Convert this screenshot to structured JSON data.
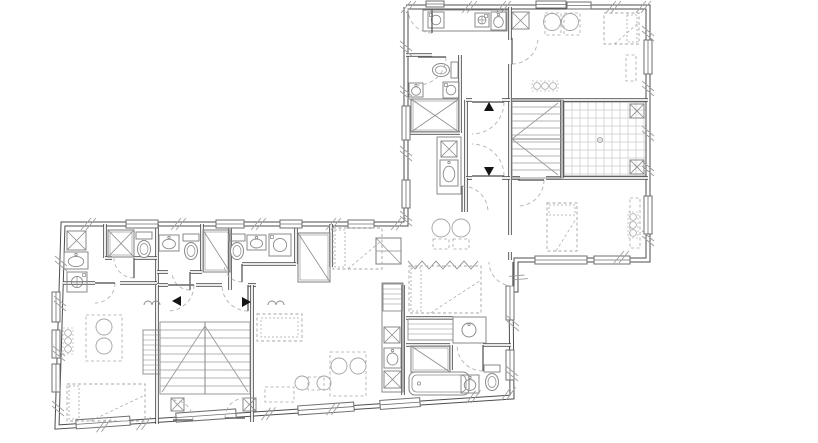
{
  "meta": {
    "canvas": {
      "w": 818,
      "h": 443
    },
    "palette": {
      "bg": "#ffffff",
      "wall": "#4d4d4d",
      "wallCore": "#ffffff",
      "fixture": "#8a8a8a",
      "furniture": "#a6a6a6",
      "window": "#6f6f6f",
      "door": "#b3b3b3",
      "leaf": "#666666",
      "stair": "#9a9a9a",
      "grid": "#cccccc",
      "marker": "#141414",
      "hatch": "#9e9e9e"
    }
  },
  "walls": {
    "exterior": [
      [
        406,
        7
      ],
      [
        648,
        7
      ],
      [
        648,
        260
      ],
      [
        516,
        260
      ],
      [
        516,
        290
      ],
      [
        511,
        290
      ],
      [
        512,
        397
      ],
      [
        57,
        427
      ],
      [
        63,
        224
      ],
      [
        406,
        224
      ],
      [
        406,
        7
      ]
    ],
    "interior": [
      [
        [
          510,
          7
        ],
        [
          510,
          40
        ]
      ],
      [
        [
          510,
          64
        ],
        [
          510,
          100
        ]
      ],
      [
        [
          510,
          100
        ],
        [
          510,
          235
        ]
      ],
      [
        [
          510,
          252
        ],
        [
          510,
          260
        ]
      ],
      [
        [
          512,
          100
        ],
        [
          648,
          100
        ]
      ],
      [
        [
          512,
          178
        ],
        [
          520,
          178
        ]
      ],
      [
        [
          546,
          178
        ],
        [
          648,
          178
        ]
      ],
      [
        [
          562,
          100
        ],
        [
          562,
          178
        ]
      ],
      [
        [
          460,
          55
        ],
        [
          460,
          133
        ]
      ],
      [
        [
          406,
          55
        ],
        [
          432,
          55
        ]
      ],
      [
        [
          406,
          133
        ],
        [
          460,
          133
        ]
      ],
      [
        [
          466,
          100
        ],
        [
          466,
          178
        ]
      ],
      [
        [
          466,
          100
        ],
        [
          472,
          100
        ]
      ],
      [
        [
          502,
          100
        ],
        [
          510,
          100
        ]
      ],
      [
        [
          466,
          178
        ],
        [
          472,
          178
        ]
      ],
      [
        [
          502,
          178
        ],
        [
          510,
          178
        ]
      ],
      [
        [
          466,
          178
        ],
        [
          466,
          212
        ]
      ],
      [
        [
          105,
          224
        ],
        [
          105,
          258
        ]
      ],
      [
        [
          157,
          224
        ],
        [
          157,
          283
        ]
      ],
      [
        [
          202,
          224
        ],
        [
          202,
          272
        ]
      ],
      [
        [
          230,
          224
        ],
        [
          230,
          290
        ]
      ],
      [
        [
          296,
          224
        ],
        [
          296,
          264
        ]
      ],
      [
        [
          331,
          224
        ],
        [
          331,
          267
        ]
      ],
      [
        [
          63,
          283
        ],
        [
          95,
          283
        ]
      ],
      [
        [
          120,
          283
        ],
        [
          157,
          283
        ]
      ],
      [
        [
          157,
          285
        ],
        [
          168,
          285
        ]
      ],
      [
        [
          196,
          285
        ],
        [
          222,
          285
        ]
      ],
      [
        [
          248,
          285
        ],
        [
          256,
          285
        ]
      ],
      [
        [
          242,
          264
        ],
        [
          296,
          264
        ]
      ],
      [
        [
          105,
          258
        ],
        [
          112,
          258
        ]
      ],
      [
        [
          134,
          258
        ],
        [
          157,
          258
        ]
      ],
      [
        [
          157,
          272
        ],
        [
          168,
          272
        ]
      ],
      [
        [
          190,
          272
        ],
        [
          202,
          272
        ]
      ],
      [
        [
          157,
          285
        ],
        [
          157,
          424
        ]
      ],
      [
        [
          252,
          285
        ],
        [
          252,
          422
        ]
      ],
      [
        [
          403,
          285
        ],
        [
          403,
          395
        ]
      ],
      [
        [
          406,
          345
        ],
        [
          450,
          345
        ]
      ],
      [
        [
          483,
          345
        ],
        [
          511,
          345
        ]
      ],
      [
        [
          451,
          345
        ],
        [
          451,
          370
        ]
      ],
      [
        [
          406,
          318
        ],
        [
          453,
          318
        ]
      ]
    ]
  },
  "windows": [
    [
      426,
      1,
      18,
      6,
      0
    ],
    [
      536,
      1,
      30,
      7,
      0
    ],
    [
      567,
      2,
      24,
      7,
      0
    ],
    [
      644,
      40,
      8,
      34,
      0
    ],
    [
      644,
      196,
      8,
      38,
      0
    ],
    [
      535,
      256,
      52,
      8,
      0
    ],
    [
      594,
      256,
      36,
      8,
      0
    ],
    [
      402,
      106,
      8,
      34,
      0
    ],
    [
      402,
      180,
      8,
      28,
      0
    ],
    [
      126,
      220,
      32,
      8,
      0
    ],
    [
      216,
      220,
      28,
      8,
      0
    ],
    [
      280,
      220,
      22,
      8,
      0
    ],
    [
      348,
      220,
      26,
      8,
      0
    ],
    [
      52,
      292,
      8,
      30,
      0
    ],
    [
      52,
      330,
      8,
      28,
      0
    ],
    [
      52,
      364,
      8,
      28,
      0
    ],
    [
      506,
      286,
      8,
      34,
      0
    ],
    [
      506,
      350,
      8,
      30,
      0
    ],
    [
      76,
      418,
      54,
      9,
      -4
    ],
    [
      176,
      411,
      60,
      9,
      -4
    ],
    [
      298,
      404,
      56,
      9,
      -4
    ],
    [
      380,
      399,
      40,
      9,
      -4
    ]
  ],
  "doors": [
    [
      432,
      9,
      24,
      90,
      180
    ],
    [
      418,
      57,
      28,
      0,
      90
    ],
    [
      472,
      102,
      32,
      0,
      90
    ],
    [
      472,
      176,
      32,
      0,
      -90
    ],
    [
      512,
      38,
      26,
      90,
      0
    ],
    [
      518,
      180,
      26,
      0,
      90
    ],
    [
      95,
      283,
      20,
      0,
      90
    ],
    [
      134,
      258,
      20,
      90,
      180
    ],
    [
      190,
      272,
      18,
      90,
      180
    ],
    [
      242,
      264,
      18,
      90,
      180
    ],
    [
      168,
      285,
      26,
      0,
      90
    ],
    [
      248,
      285,
      26,
      90,
      180
    ],
    [
      173,
      420,
      20,
      0,
      -90
    ],
    [
      245,
      418,
      20,
      180,
      270
    ],
    [
      483,
      345,
      26,
      90,
      180
    ],
    [
      513,
      262,
      24,
      90,
      180
    ],
    [
      462,
      212,
      26,
      -90,
      0
    ]
  ],
  "markers": [
    [
      489,
      107,
      "up"
    ],
    [
      489,
      171,
      "down"
    ],
    [
      177,
      301,
      "left"
    ],
    [
      246,
      302,
      "right"
    ]
  ],
  "stairs": [
    {
      "x": 512,
      "y": 100,
      "w": 50,
      "h": 78,
      "step": 7,
      "diag": [
        [
          512,
          139,
          558,
          103
        ],
        [
          512,
          139,
          558,
          175
        ]
      ],
      "mid": [
        512,
        139,
        562,
        139
      ]
    },
    {
      "x": 160,
      "y": 322,
      "w": 90,
      "h": 72,
      "step": 8,
      "diag": [
        [
          162,
          392,
          205,
          326
        ],
        [
          248,
          392,
          205,
          326
        ]
      ],
      "mid": [
        205,
        322,
        205,
        394
      ]
    }
  ],
  "grids": [
    [
      564,
      102,
      82,
      74,
      8
    ]
  ],
  "zigzags": [
    [
      408,
      265,
      480,
      4,
      7
    ]
  ],
  "bifolds": [
    [
      144,
      305,
      16
    ],
    [
      268,
      305,
      16
    ]
  ],
  "hatches": [
    [
      405,
      7,
      0
    ],
    [
      466,
      7,
      0
    ],
    [
      500,
      7,
      0
    ],
    [
      610,
      7,
      0
    ],
    [
      640,
      7,
      0
    ],
    [
      648,
      30,
      90
    ],
    [
      648,
      85,
      90
    ],
    [
      648,
      130,
      90
    ],
    [
      648,
      165,
      90
    ],
    [
      648,
      235,
      90
    ],
    [
      618,
      257,
      0
    ],
    [
      406,
      45,
      90
    ],
    [
      406,
      90,
      90
    ],
    [
      406,
      150,
      90
    ],
    [
      406,
      215,
      90
    ],
    [
      85,
      224,
      0
    ],
    [
      175,
      224,
      0
    ],
    [
      255,
      224,
      0
    ],
    [
      330,
      224,
      0
    ],
    [
      395,
      224,
      0
    ],
    [
      61,
      260,
      90
    ],
    [
      60,
      300,
      90
    ],
    [
      59,
      350,
      90
    ],
    [
      58,
      405,
      90
    ],
    [
      100,
      426,
      -4
    ],
    [
      140,
      424,
      -4
    ],
    [
      265,
      414,
      -4
    ],
    [
      330,
      409,
      -4
    ],
    [
      470,
      397,
      -4
    ],
    [
      505,
      394,
      -4
    ],
    [
      513,
      320,
      90
    ],
    [
      512,
      370,
      90
    ],
    [
      516,
      275,
      45
    ]
  ],
  "fixtures": [
    {
      "t": "counter",
      "x": 423,
      "y": 10,
      "w": 84,
      "h": 21
    },
    {
      "t": "counter",
      "x": 437,
      "y": 137,
      "w": 24,
      "h": 57
    },
    {
      "t": "counter",
      "x": 453,
      "y": 317,
      "w": 33,
      "h": 26
    },
    {
      "t": "counter",
      "x": 382,
      "y": 283,
      "w": 21,
      "h": 109
    },
    {
      "t": "shelf",
      "x": 383,
      "y": 284,
      "w": 19,
      "h": 27
    },
    {
      "t": "shelf",
      "x": 408,
      "y": 319,
      "w": 45,
      "h": 21
    },
    {
      "t": "shelf",
      "x": 143,
      "y": 330,
      "w": 17,
      "h": 44
    },
    {
      "t": "shelfs",
      "x": 376,
      "y": 238,
      "w": 25,
      "h": 26
    },
    {
      "t": "washer",
      "x": 428,
      "y": 12,
      "s": 16
    },
    {
      "t": "washer",
      "x": 443,
      "y": 82,
      "s": 16
    },
    {
      "t": "washer",
      "x": 269,
      "y": 234,
      "s": 22
    },
    {
      "t": "stove",
      "x": 475,
      "y": 13,
      "s": 14
    },
    {
      "t": "stove",
      "x": 67,
      "y": 272,
      "s": 20
    },
    {
      "t": "shaftx",
      "x": 512,
      "y": 12,
      "s": 17
    },
    {
      "t": "shaftx",
      "x": 67,
      "y": 231,
      "s": 19
    },
    {
      "t": "shaftx",
      "x": 384,
      "y": 371,
      "s": 17
    },
    {
      "t": "shaftx",
      "x": 384,
      "y": 327,
      "s": 16
    },
    {
      "t": "shaftx",
      "x": 441,
      "y": 141,
      "s": 16
    },
    {
      "t": "shaftx",
      "x": 171,
      "y": 398,
      "s": 13
    },
    {
      "t": "shaftx",
      "x": 243,
      "y": 398,
      "s": 13
    },
    {
      "t": "shaftx",
      "x": 630,
      "y": 104,
      "s": 14
    },
    {
      "t": "shaftx",
      "x": 630,
      "y": 160,
      "s": 14
    },
    {
      "t": "sink",
      "x": 491,
      "y": 12,
      "w": 15,
      "h": 18
    },
    {
      "t": "sink",
      "x": 409,
      "y": 83,
      "w": 14,
      "h": 14
    },
    {
      "t": "sink",
      "x": 440,
      "y": 160,
      "w": 18,
      "h": 26
    },
    {
      "t": "sink",
      "x": 64,
      "y": 252,
      "w": 24,
      "h": 17
    },
    {
      "t": "sink",
      "x": 159,
      "y": 235,
      "w": 20,
      "h": 16
    },
    {
      "t": "sink",
      "x": 247,
      "y": 235,
      "w": 19,
      "h": 15
    },
    {
      "t": "sink",
      "x": 461,
      "y": 375,
      "w": 18,
      "h": 18
    },
    {
      "t": "sink",
      "x": 384,
      "y": 348,
      "w": 17,
      "h": 20
    },
    {
      "t": "sinkc",
      "x": 469,
      "y": 330,
      "r": 7
    },
    {
      "t": "toilet",
      "x": 456,
      "y": 70,
      "rot": 90
    },
    {
      "t": "toilet",
      "x": 144,
      "y": 234,
      "rot": 0
    },
    {
      "t": "toilet",
      "x": 191,
      "y": 236,
      "rot": 0
    },
    {
      "t": "toilet",
      "x": 237,
      "y": 236,
      "rot": 0
    },
    {
      "t": "toilet",
      "x": 492,
      "y": 367,
      "rot": 0
    },
    {
      "t": "shower",
      "x": 411,
      "y": 99,
      "w": 48,
      "h": 33,
      "d": 2
    },
    {
      "t": "shower",
      "x": 108,
      "y": 230,
      "w": 26,
      "h": 27,
      "d": 2
    },
    {
      "t": "shower",
      "x": 203,
      "y": 230,
      "w": 27,
      "h": 42,
      "d": 1
    },
    {
      "t": "shower",
      "x": 298,
      "y": 233,
      "w": 32,
      "h": 49,
      "d": 1
    },
    {
      "t": "shower",
      "x": 411,
      "y": 346,
      "w": 39,
      "h": 26,
      "d": 1
    },
    {
      "t": "tub",
      "x": 409,
      "y": 372,
      "w": 60,
      "h": 23
    },
    {
      "t": "dot",
      "x": 600,
      "y": 140,
      "r": 2.5
    }
  ],
  "furniture": [
    {
      "t": "bed",
      "x": 604,
      "y": 13,
      "w": 35,
      "h": 31,
      "p": "r"
    },
    {
      "t": "bed",
      "x": 547,
      "y": 203,
      "w": 30,
      "h": 48,
      "p": "t"
    },
    {
      "t": "bed",
      "x": 333,
      "y": 228,
      "w": 49,
      "h": 41,
      "p": "l"
    },
    {
      "t": "bed",
      "x": 67,
      "y": 384,
      "w": 78,
      "h": 37,
      "p": "l"
    },
    {
      "t": "bed",
      "x": 409,
      "y": 266,
      "w": 72,
      "h": 47,
      "p": "l"
    },
    {
      "t": "sofa",
      "x": 257,
      "y": 314,
      "w": 45,
      "h": 27
    },
    {
      "t": "tabled",
      "x": 545,
      "y": 13,
      "w": 16,
      "h": 22
    },
    {
      "t": "tabled",
      "x": 564,
      "y": 13,
      "w": 16,
      "h": 22
    },
    {
      "t": "tabled",
      "x": 433,
      "y": 239,
      "w": 16,
      "h": 10
    },
    {
      "t": "tabled",
      "x": 453,
      "y": 239,
      "w": 16,
      "h": 10
    },
    {
      "t": "tabled",
      "x": 86,
      "y": 315,
      "w": 36,
      "h": 46
    },
    {
      "t": "tabled",
      "x": 330,
      "y": 352,
      "w": 36,
      "h": 44
    },
    {
      "t": "tabled",
      "x": 308,
      "y": 377,
      "w": 16,
      "h": 13
    },
    {
      "t": "tabled",
      "x": 626,
      "y": 55,
      "w": 10,
      "h": 26
    },
    {
      "t": "tabled",
      "x": 630,
      "y": 198,
      "w": 10,
      "h": 50
    },
    {
      "t": "tabled",
      "x": 265,
      "y": 387,
      "w": 29,
      "h": 15
    },
    {
      "t": "chair",
      "x": 552,
      "y": 22,
      "r": 8.5
    },
    {
      "t": "chair",
      "x": 570,
      "y": 22,
      "r": 8.5
    },
    {
      "t": "chair",
      "x": 441,
      "y": 228,
      "r": 9
    },
    {
      "t": "chair",
      "x": 461,
      "y": 228,
      "r": 9
    },
    {
      "t": "chair",
      "x": 104,
      "y": 327,
      "r": 8
    },
    {
      "t": "chair",
      "x": 104,
      "y": 346,
      "r": 8
    },
    {
      "t": "chair",
      "x": 339,
      "y": 366,
      "r": 8
    },
    {
      "t": "chair",
      "x": 358,
      "y": 366,
      "r": 8
    },
    {
      "t": "chair",
      "x": 302,
      "y": 383,
      "r": 7
    },
    {
      "t": "chair",
      "x": 324,
      "y": 383,
      "r": 7
    },
    {
      "t": "plant",
      "x": 545,
      "y": 86,
      "o": "h"
    },
    {
      "t": "plant",
      "x": 633,
      "y": 225,
      "o": "v"
    },
    {
      "t": "plant",
      "x": 68,
      "y": 341,
      "o": "v"
    }
  ]
}
